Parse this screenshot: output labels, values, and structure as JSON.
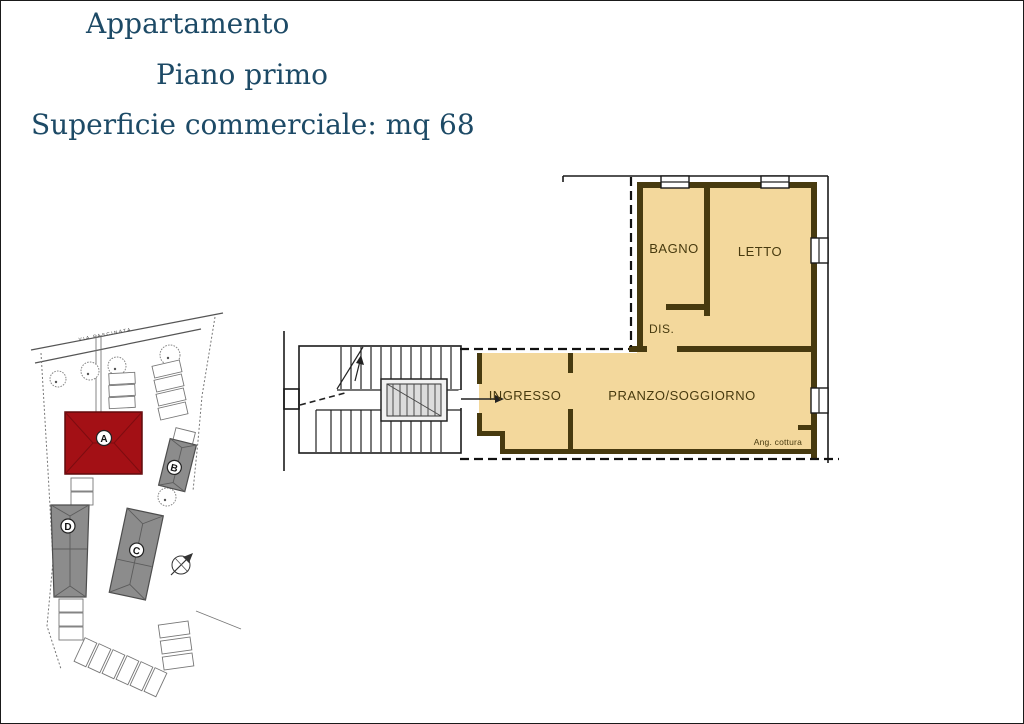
{
  "header": {
    "title": "Appartamento",
    "subtitle": "Piano primo",
    "surface": "Superficie commerciale: mq 68",
    "text_color": "#1d4a66"
  },
  "floor_plan": {
    "rooms": {
      "bagno": "BAGNO",
      "letto": "LETTO",
      "dis": "DIS.",
      "ingresso": "INGRESSO",
      "pranzo": "PRANZO/SOGGIORNO",
      "ang_cottura": "Ang. cottura"
    },
    "colors": {
      "floor": "#f3d89c",
      "wall": "#473a0f",
      "outline": "#1a1a1a"
    }
  },
  "site_plan": {
    "street_label": "VIA FASCINATA",
    "buildings": {
      "a": "A",
      "b": "B",
      "c": "C",
      "d": "D"
    },
    "highlight_color": "#a31015",
    "building_color": "#8c8c8c",
    "line_color": "#777777"
  }
}
